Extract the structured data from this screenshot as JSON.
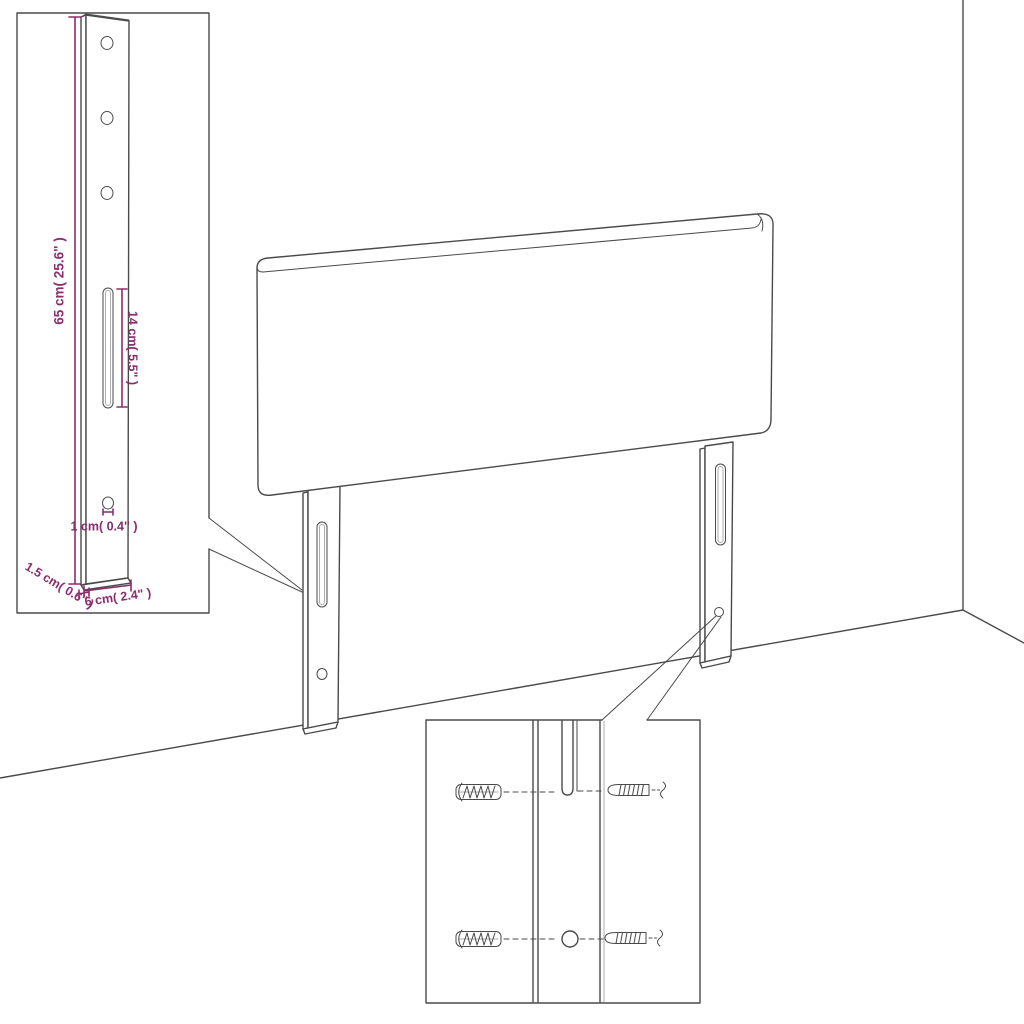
{
  "diagram": {
    "type": "furniture-assembly-dimension-diagram",
    "colors": {
      "line": "#4a4a4a",
      "dimension": "#8a2e6c",
      "background": "#ffffff"
    },
    "bracket_inset": {
      "labels": {
        "height": "65 cm( 25.6\" )",
        "slot_length": "14 cm( 5.5\" )",
        "hole_diameter": "1 cm( 0.4\" )",
        "thickness": "1.5 cm( 0.6\" )",
        "width": "6 cm( 2.4\" )"
      },
      "screw_holes": 3,
      "slots": 1
    },
    "hardware_inset": {
      "wall_plugs": 2,
      "screws": 2
    },
    "main_view": {
      "legs": 2
    }
  }
}
